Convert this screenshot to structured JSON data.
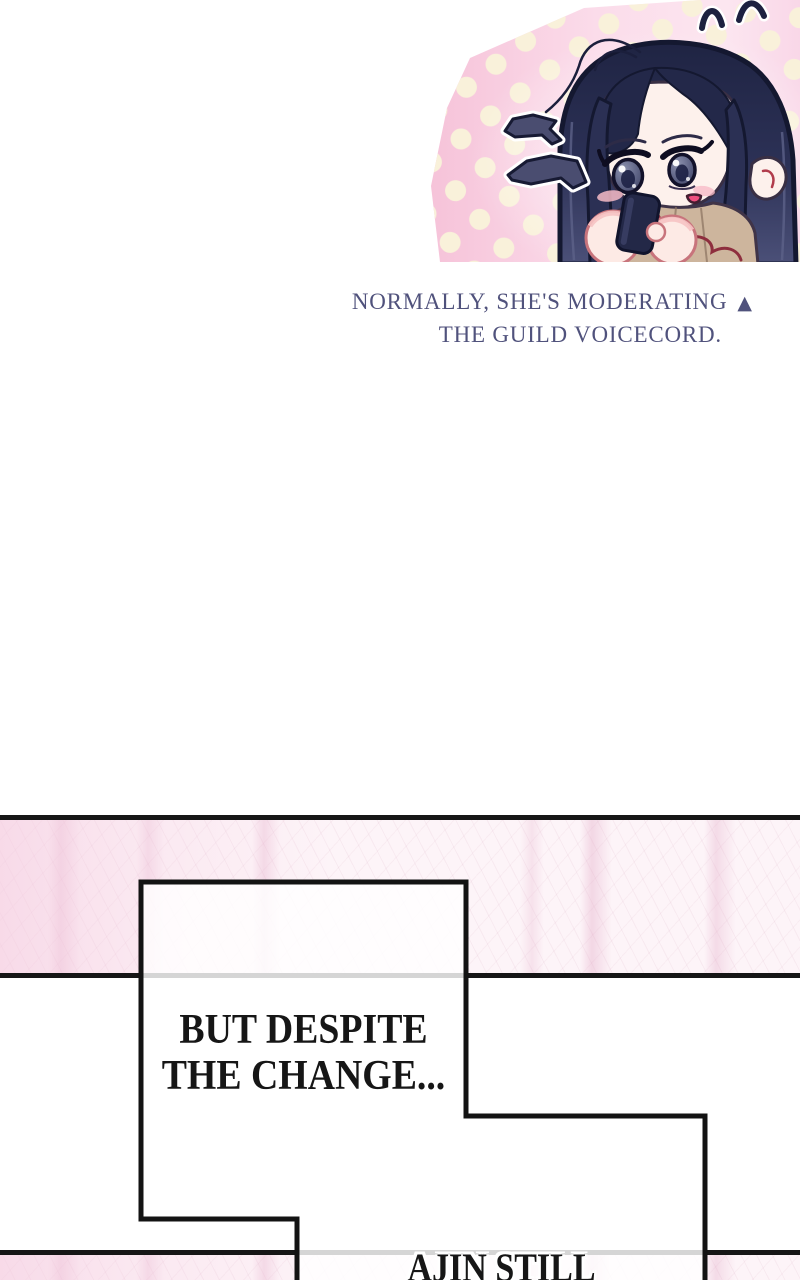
{
  "page": {
    "width_px": 800,
    "height_px": 1280,
    "background": "#ffffff"
  },
  "illustration": {
    "name": "chibi-girl-checking-phone",
    "panel_background_pink": "#f7c9dd",
    "polka_dot_color": "#f9f1da",
    "hair_color": "#272c4e",
    "skin_color": "#fdf1ec",
    "eye_color": "#5d6284",
    "outfit_color": "#cdb59d",
    "phone_color": "#232847",
    "speech_burst_color": "#4a4d70",
    "fluster_mark_color": "#1d2140",
    "blush_color": "#f7bcc8",
    "cord_color": "#8e2e3e"
  },
  "caption": {
    "line1": "NORMALLY, SHE'S MODERATING",
    "marker": "▲",
    "line2": "THE GUILD VOICECORD.",
    "text_color": "#50527c"
  },
  "panels": {
    "rule_color": "#161616",
    "pink_fill": "#fdf4f8",
    "speech_box": {
      "fill": "rgba(255,255,255,0.82)",
      "border_color": "#131313",
      "box1_line1": "BUT DESPITE",
      "box1_line2": "THE CHANGE...",
      "box2_line1": "AJIN STILL",
      "text_color": "#161616"
    }
  }
}
